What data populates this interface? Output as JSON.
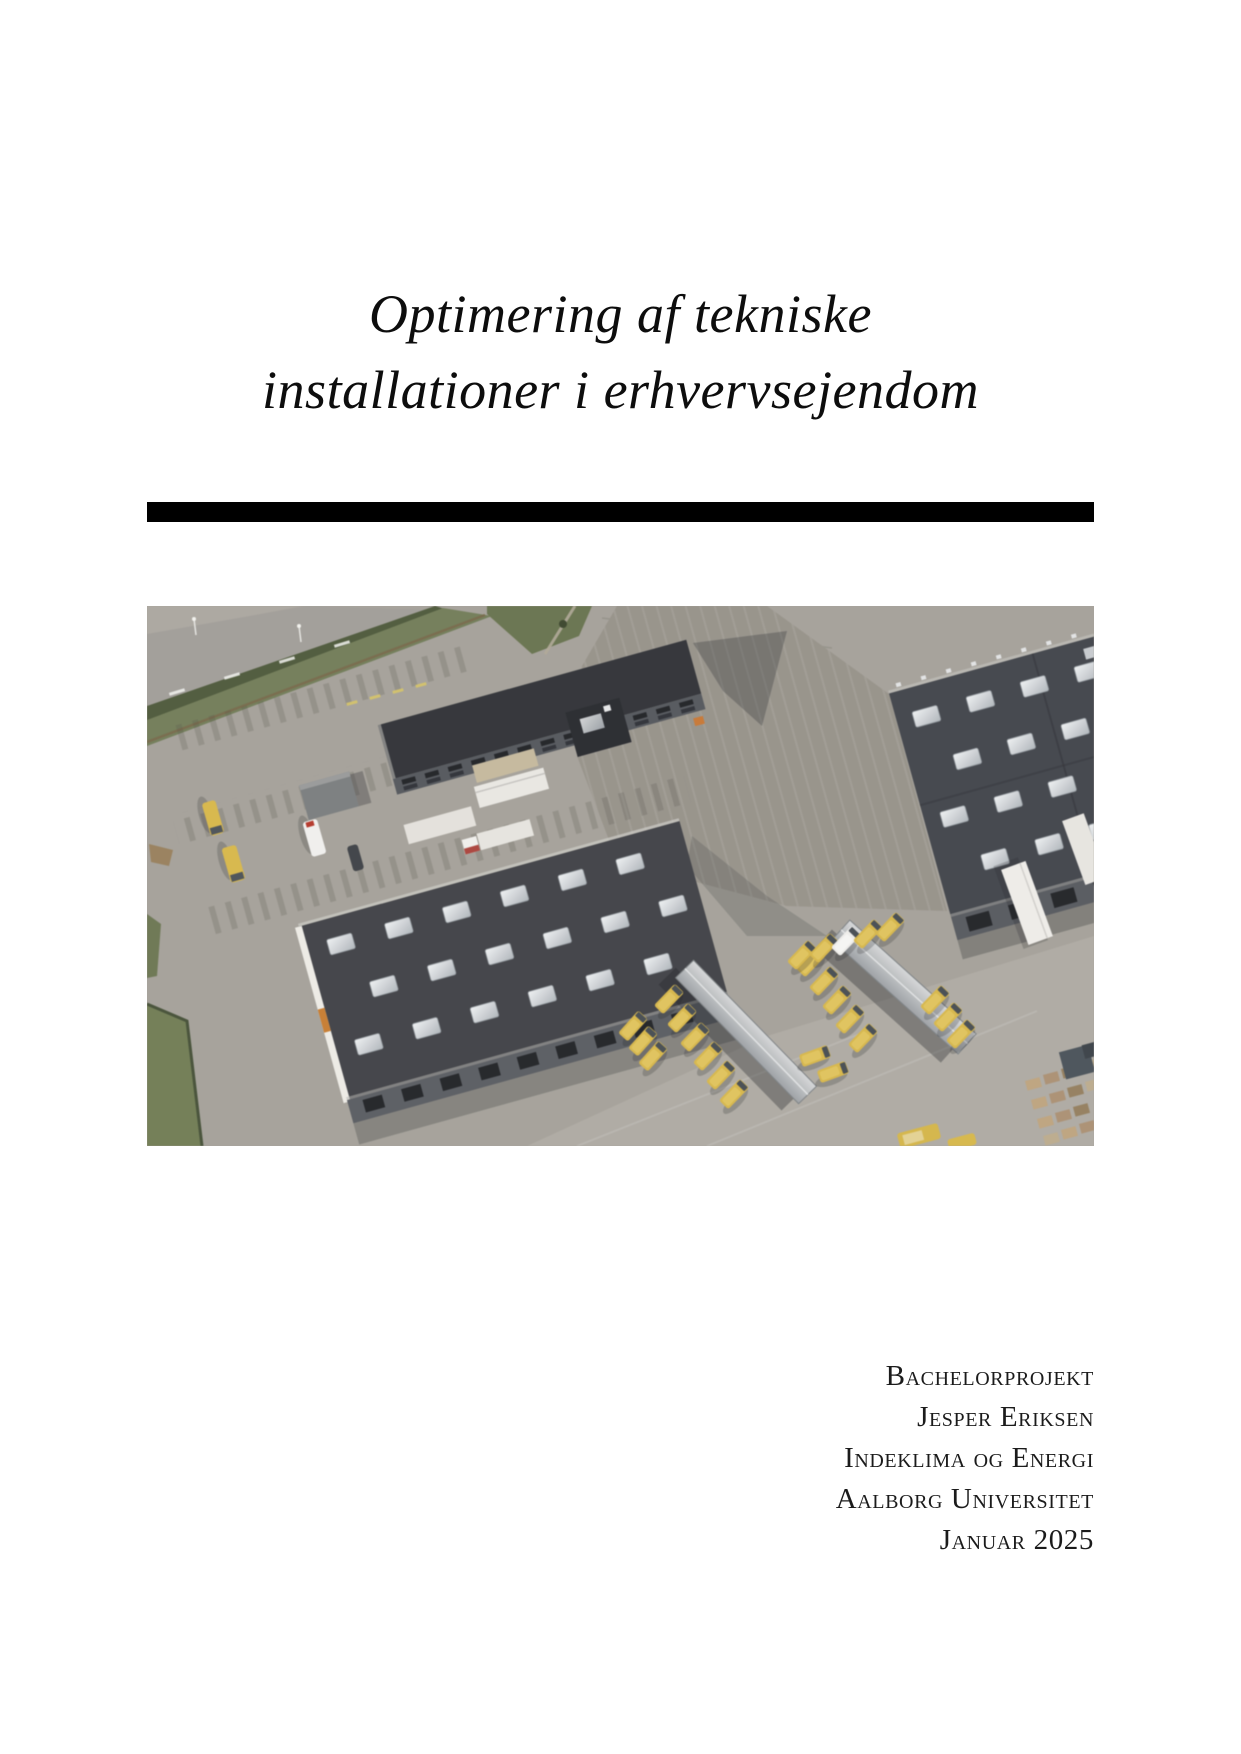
{
  "title": {
    "line1": "Optimering af tekniske",
    "line2": "installationer i erhvervsejendom"
  },
  "divider": {
    "color": "#000000"
  },
  "cover_image": {
    "description": "Aerial photograph of an industrial logistics facility: dark flat-roofed warehouse buildings with rows of skylights, an office block, loading canopies with yellow delivery vans, white trailers, gray asphalt parking areas, grass verges and pallet stacks"
  },
  "footer": {
    "lines": [
      "Bachelorprojekt",
      "Jesper Eriksen",
      "Indeklima og Energi",
      "Aalborg Universitet",
      "Januar 2025"
    ]
  }
}
